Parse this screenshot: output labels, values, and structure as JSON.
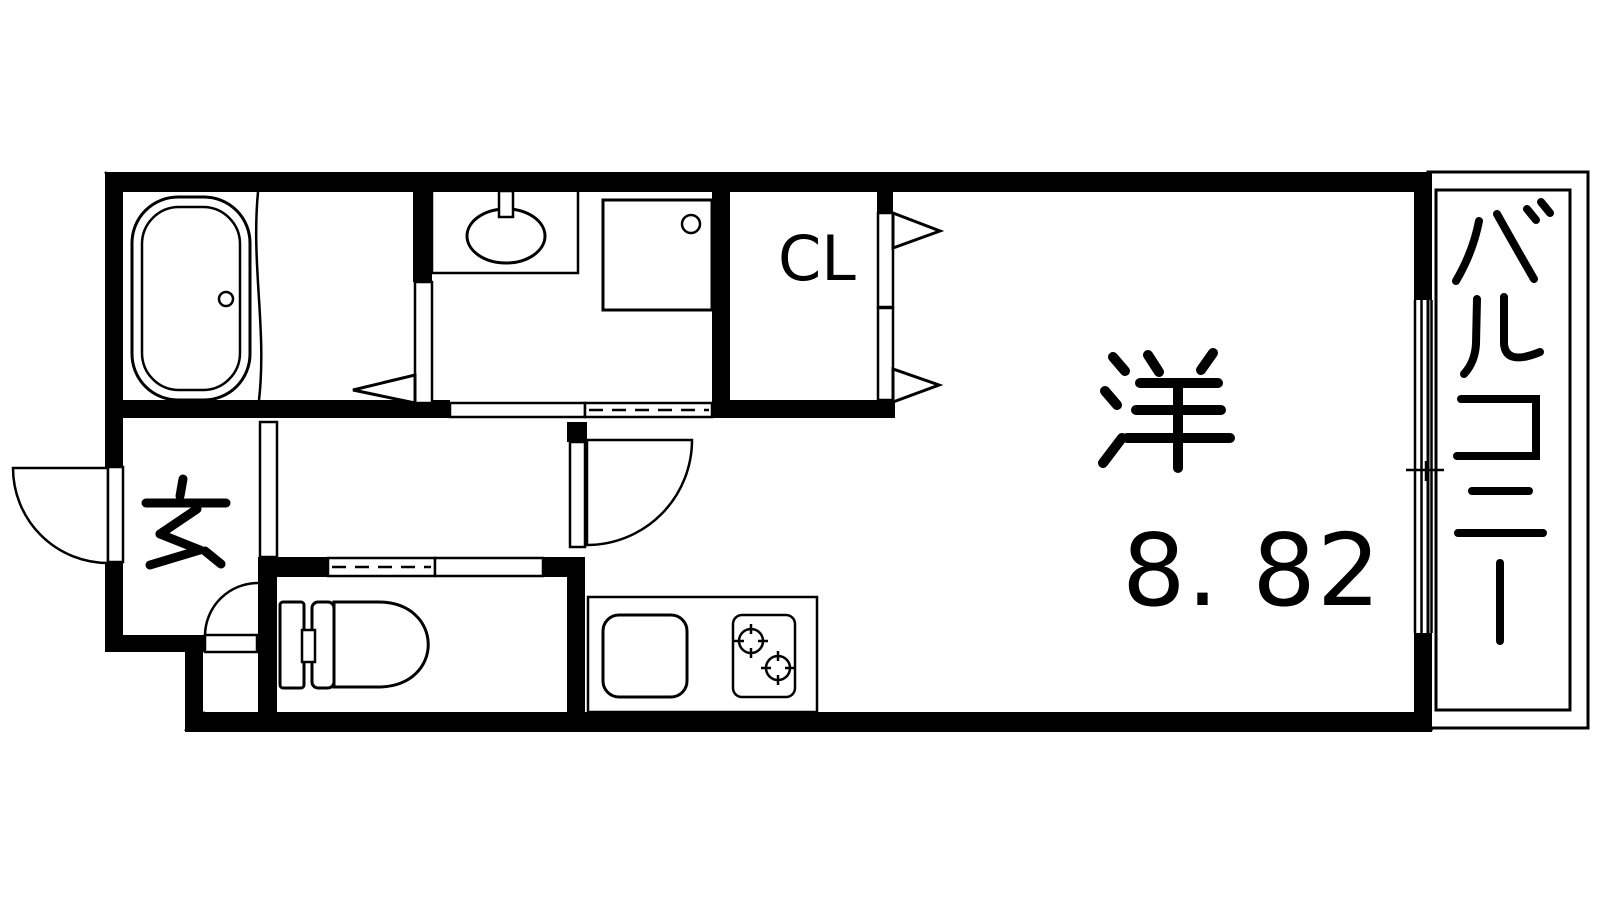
{
  "plan": {
    "labels": {
      "western_room": "洋",
      "western_room_size": "8. 82",
      "closet": "CL",
      "entrance": "玄",
      "balcony": "バルコニー"
    },
    "colors": {
      "line": "#000000",
      "background": "#ffffff"
    },
    "fixture_icons": [
      "bathtub-icon",
      "washbasin-icon",
      "washing-machine-pan-icon",
      "toilet-icon",
      "kitchen-sink-icon",
      "gas-stove-icon",
      "door-swing-icon",
      "sliding-door-icon",
      "bifold-door-arrow-icon",
      "window-icon"
    ]
  }
}
